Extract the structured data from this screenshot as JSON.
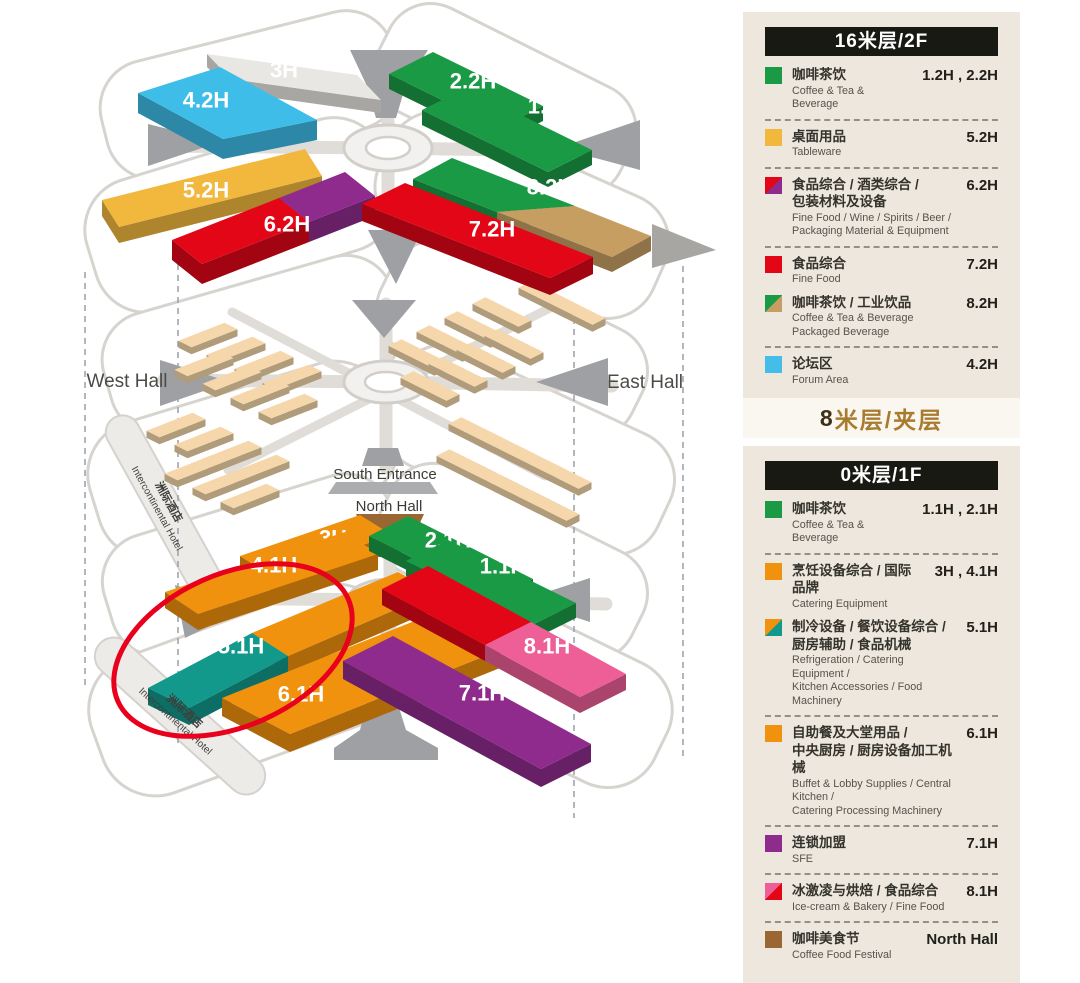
{
  "map": {
    "labels": {
      "west_hall": "West Hall",
      "east_hall": "East Hall",
      "south_entrance": "South Entrance",
      "north_hall": "North Hall",
      "hotel_cn": "洲际酒店",
      "hotel_en": "Intercontinental Hotel"
    },
    "annotation_color": "#E8001C",
    "halls": [
      {
        "id": "h3_2f",
        "lvl": "2f",
        "label": "3H",
        "colors": [
          "#E9E7E3"
        ]
      },
      {
        "id": "h42",
        "lvl": "2f",
        "label": "4.2H",
        "colors": [
          "#3FBDE9"
        ]
      },
      {
        "id": "h22",
        "lvl": "2f",
        "label": "2.2H",
        "colors": [
          "#1B9A45"
        ]
      },
      {
        "id": "h12",
        "lvl": "2f",
        "label": "1.2H",
        "colors": [
          "#1B9A45"
        ]
      },
      {
        "id": "h52",
        "lvl": "2f",
        "label": "5.2H",
        "colors": [
          "#F2B73D"
        ]
      },
      {
        "id": "h62",
        "lvl": "2f",
        "label": "6.2H",
        "colors": [
          "#E30617",
          "#8F2B8C"
        ]
      },
      {
        "id": "h82",
        "lvl": "2f",
        "label": "8.2H",
        "colors": [
          "#1B9A45",
          "#C79E62"
        ]
      },
      {
        "id": "h72",
        "lvl": "2f",
        "label": "7.2H",
        "colors": [
          "#E30617"
        ]
      },
      {
        "id": "h3_1f",
        "lvl": "1f",
        "label": "3H",
        "colors": [
          "#F0920D"
        ]
      },
      {
        "id": "h41",
        "lvl": "1f",
        "label": "4.1H",
        "colors": [
          "#F0920D"
        ]
      },
      {
        "id": "h21",
        "lvl": "1f",
        "label": "2.1H",
        "colors": [
          "#1B9A45"
        ]
      },
      {
        "id": "h11",
        "lvl": "1f",
        "label": "1.1H",
        "colors": [
          "#1B9A45"
        ]
      },
      {
        "id": "h51",
        "lvl": "1f",
        "label": "5.1H",
        "colors": [
          "#12998C",
          "#F0920D"
        ]
      },
      {
        "id": "h61",
        "lvl": "1f",
        "label": "6.1H",
        "colors": [
          "#F0920D"
        ]
      },
      {
        "id": "h81",
        "lvl": "1f",
        "label": "8.1H",
        "colors": [
          "#E30617",
          "#EE5F98"
        ]
      },
      {
        "id": "h71",
        "lvl": "1f",
        "label": "7.1H",
        "colors": [
          "#8F2B8C"
        ]
      }
    ]
  },
  "legend": {
    "mezzanine_title": "8米层/夹层",
    "sections": [
      {
        "id": "2f",
        "title": "16米层/2F",
        "items": [
          {
            "swatch": [
              "#1B9A45"
            ],
            "cn": [
              "咖啡茶饮"
            ],
            "en": [
              "Coffee & Tea & Beverage"
            ],
            "code": "1.2H , 2.2H",
            "sep": true
          },
          {
            "swatch": [
              "#F2B73D"
            ],
            "cn": [
              "桌面用品"
            ],
            "en": [
              "Tableware"
            ],
            "code": "5.2H",
            "sep": true
          },
          {
            "swatch": [
              "#E30617",
              "#8F2B8C"
            ],
            "cn": [
              "食品综合 / 酒类综合 /",
              "包装材料及设备"
            ],
            "en": [
              "Fine Food / Wine / Spirits / Beer /",
              "Packaging Material & Equipment"
            ],
            "code": "6.2H",
            "sep": true
          },
          {
            "swatch": [
              "#E30617"
            ],
            "cn": [
              "食品综合"
            ],
            "en": [
              "Fine Food"
            ],
            "code": "7.2H",
            "sep": false
          },
          {
            "swatch": [
              "#1B9A45",
              "#C79E62"
            ],
            "cn": [
              "咖啡茶饮 / 工业饮品"
            ],
            "en": [
              "Coffee & Tea & Beverage",
              "Packaged Beverage"
            ],
            "code": "8.2H",
            "sep": true
          },
          {
            "swatch": [
              "#45BDE9"
            ],
            "cn": [
              "论坛区"
            ],
            "en": [
              "Forum Area"
            ],
            "code": "4.2H",
            "sep": false
          }
        ]
      },
      {
        "id": "1f",
        "title": "0米层/1F",
        "items": [
          {
            "swatch": [
              "#1B9A45"
            ],
            "cn": [
              "咖啡茶饮"
            ],
            "en": [
              "Coffee & Tea & Beverage"
            ],
            "code": "1.1H , 2.1H",
            "sep": true
          },
          {
            "swatch": [
              "#F0920D"
            ],
            "cn": [
              "烹饪设备综合 / 国际品牌"
            ],
            "en": [
              "Catering Equipment"
            ],
            "code": "3H , 4.1H",
            "sep": false
          },
          {
            "swatch": [
              "#F0920D",
              "#12998C"
            ],
            "cn": [
              "制冷设备 / 餐饮设备综合 /",
              "厨房辅助 / 食品机械"
            ],
            "en": [
              "Refrigeration / Catering Equipment /",
              "Kitchen Accessories / Food Machinery"
            ],
            "code": "5.1H",
            "sep": true
          },
          {
            "swatch": [
              "#F0920D"
            ],
            "cn": [
              "自助餐及大堂用品 /",
              "中央厨房 / 厨房设备加工机械"
            ],
            "en": [
              "Buffet & Lobby Supplies / Central Kitchen /",
              "Catering Processing Machinery"
            ],
            "code": "6.1H",
            "sep": true
          },
          {
            "swatch": [
              "#8F2B8C"
            ],
            "cn": [
              "连锁加盟"
            ],
            "en": [
              "SFE"
            ],
            "code": "7.1H",
            "sep": true
          },
          {
            "swatch": [
              "#EE5F98",
              "#E30617"
            ],
            "cn": [
              "冰激凌与烘焙 / 食品综合"
            ],
            "en": [
              "Ice-cream & Bakery / Fine Food"
            ],
            "code": "8.1H",
            "sep": true
          },
          {
            "swatch": [
              "#9A6733"
            ],
            "cn": [
              "咖啡美食节"
            ],
            "en": [
              "Coffee Food Festival"
            ],
            "code": "North Hall",
            "sep": false
          }
        ]
      }
    ]
  }
}
